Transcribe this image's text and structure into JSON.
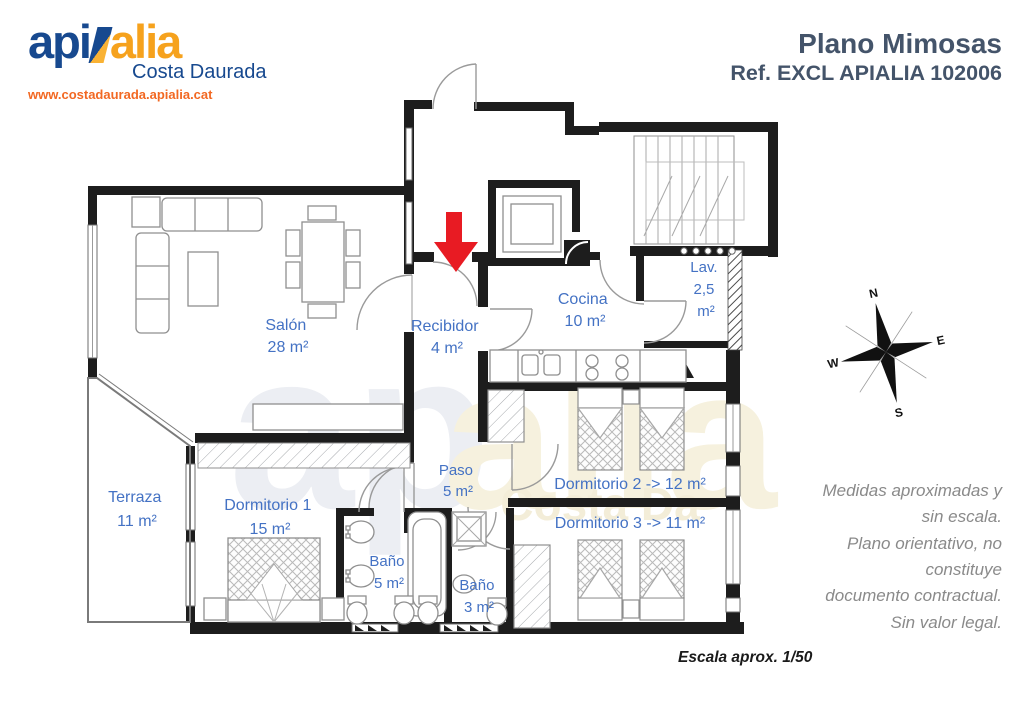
{
  "header": {
    "logo": {
      "word_api": "api",
      "word_alia": "alia",
      "subtitle": "Costa Daurada",
      "url": "www.costadaurada.apialia.cat"
    },
    "title": "Plano Mimosas",
    "reference": "Ref. EXCL APIALIA 102006"
  },
  "plan": {
    "rooms": {
      "salon": {
        "name": "Salón",
        "area": "28 m²"
      },
      "recibidor": {
        "name": "Recibidor",
        "area": "4 m²"
      },
      "cocina": {
        "name": "Cocina",
        "area": "10 m²"
      },
      "lavadero": {
        "line1": "Lav.",
        "line2": "2,5",
        "line3": "m²"
      },
      "terraza": {
        "name": "Terraza",
        "area": "11 m²"
      },
      "dormitorio1": {
        "name": "Dormitorio 1",
        "area": "15 m²"
      },
      "paso": {
        "name": "Paso",
        "area": "5 m²"
      },
      "dormitorio2": {
        "label": "Dormitorio 2 -> 12 m²"
      },
      "dormitorio3": {
        "label": "Dormitorio 3 -> 11 m²"
      },
      "banyo5": {
        "name": "Baño",
        "area": "5 m²"
      },
      "banyo3": {
        "name": "Baño",
        "area": "3 m²"
      }
    },
    "watermark": {
      "line1": "ap",
      "line2": "alia",
      "line3": "Costa Da"
    },
    "compass": {
      "n": "N",
      "e": "E",
      "s": "S",
      "w": "W"
    }
  },
  "notes": {
    "disclaimer_lines": [
      "Medidas aproximadas y",
      "sin escala.",
      "Plano orientativo, no",
      "constituye",
      "documento contractual.",
      "Sin valor legal."
    ],
    "scale_note": "Escala aprox. 1/50"
  },
  "colors": {
    "label_blue": "#4472C4",
    "title_blue": "#44546A",
    "logo_blue": "#17498F",
    "logo_orange": "#F6A21D",
    "url_orange": "#F26822",
    "arrow_red": "#E81B23",
    "disclaimer_gray": "#8A8A8A"
  }
}
